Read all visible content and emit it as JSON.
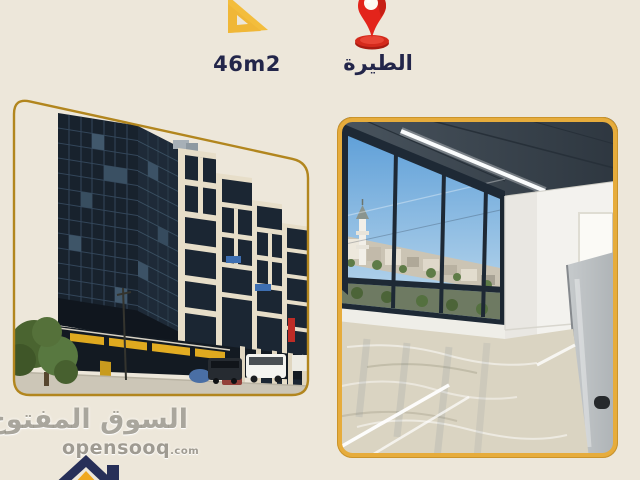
{
  "page": {
    "background": "#EDE7DA"
  },
  "area_badge": {
    "label": "46m2",
    "icon": "set-square-ruler-icon",
    "icon_color": "#F3BD3C",
    "text_color": "#23264A"
  },
  "location_badge": {
    "label": "الطيرة",
    "icon": "map-pin-icon",
    "icon_color": "#E3241B",
    "text_color": "#23264A"
  },
  "photos": {
    "exterior": {
      "frame_color": "#B2861E"
    },
    "interior": {
      "frame_color": "#E6AC3C"
    }
  },
  "watermark": {
    "brand_arabic": "السوق المفتوح",
    "brand_latin": "opensooq",
    "brand_suffix": ".com",
    "logo_navy": "#272F58",
    "logo_yellow": "#F0A81F"
  }
}
